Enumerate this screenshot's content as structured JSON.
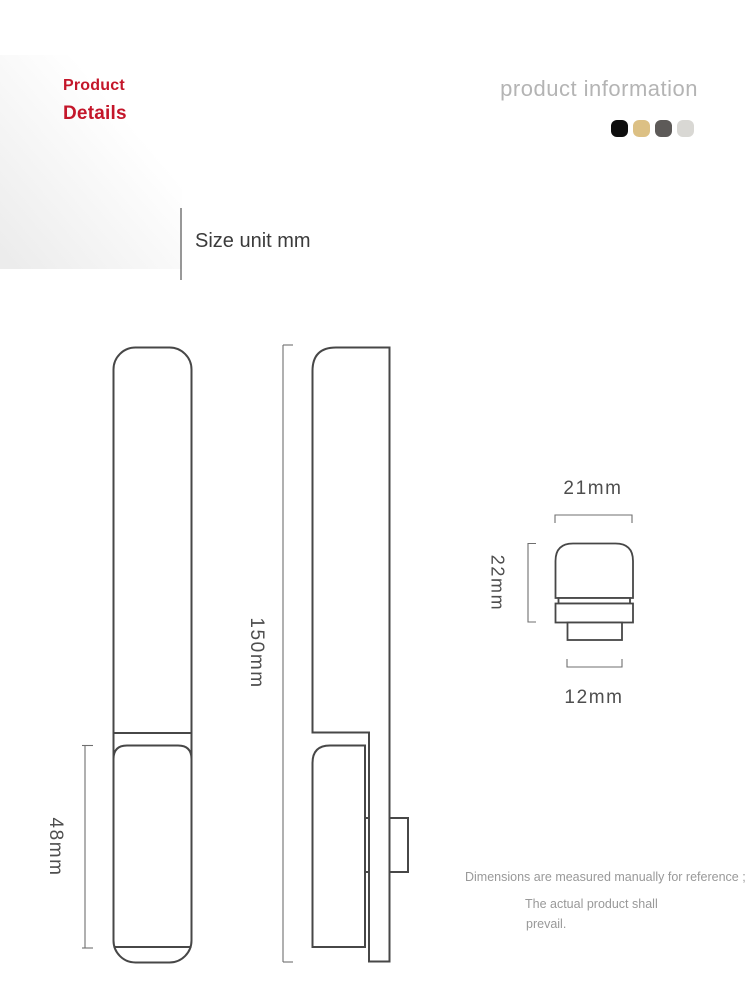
{
  "header": {
    "title_line1": "Product",
    "title_line2": "Details",
    "accent_color": "#c4162a",
    "section_title": "product information",
    "swatch_colors": [
      "#0e0e0e",
      "#dcc084",
      "#5d5a58",
      "#d9d8d4"
    ]
  },
  "size_note": "Size unit mm",
  "dimensions": {
    "grip_height": "48mm",
    "overall_height": "150mm",
    "knob_width": "21mm",
    "knob_height": "22mm",
    "knob_stem_width": "12mm"
  },
  "disclaimer": {
    "line1": "Dimensions are measured manually for reference ;",
    "line2": "The actual product shall",
    "line3": "prevail."
  },
  "drawing": {
    "outline_color": "#474747",
    "dimension_line_color": "#6f6f6f"
  }
}
